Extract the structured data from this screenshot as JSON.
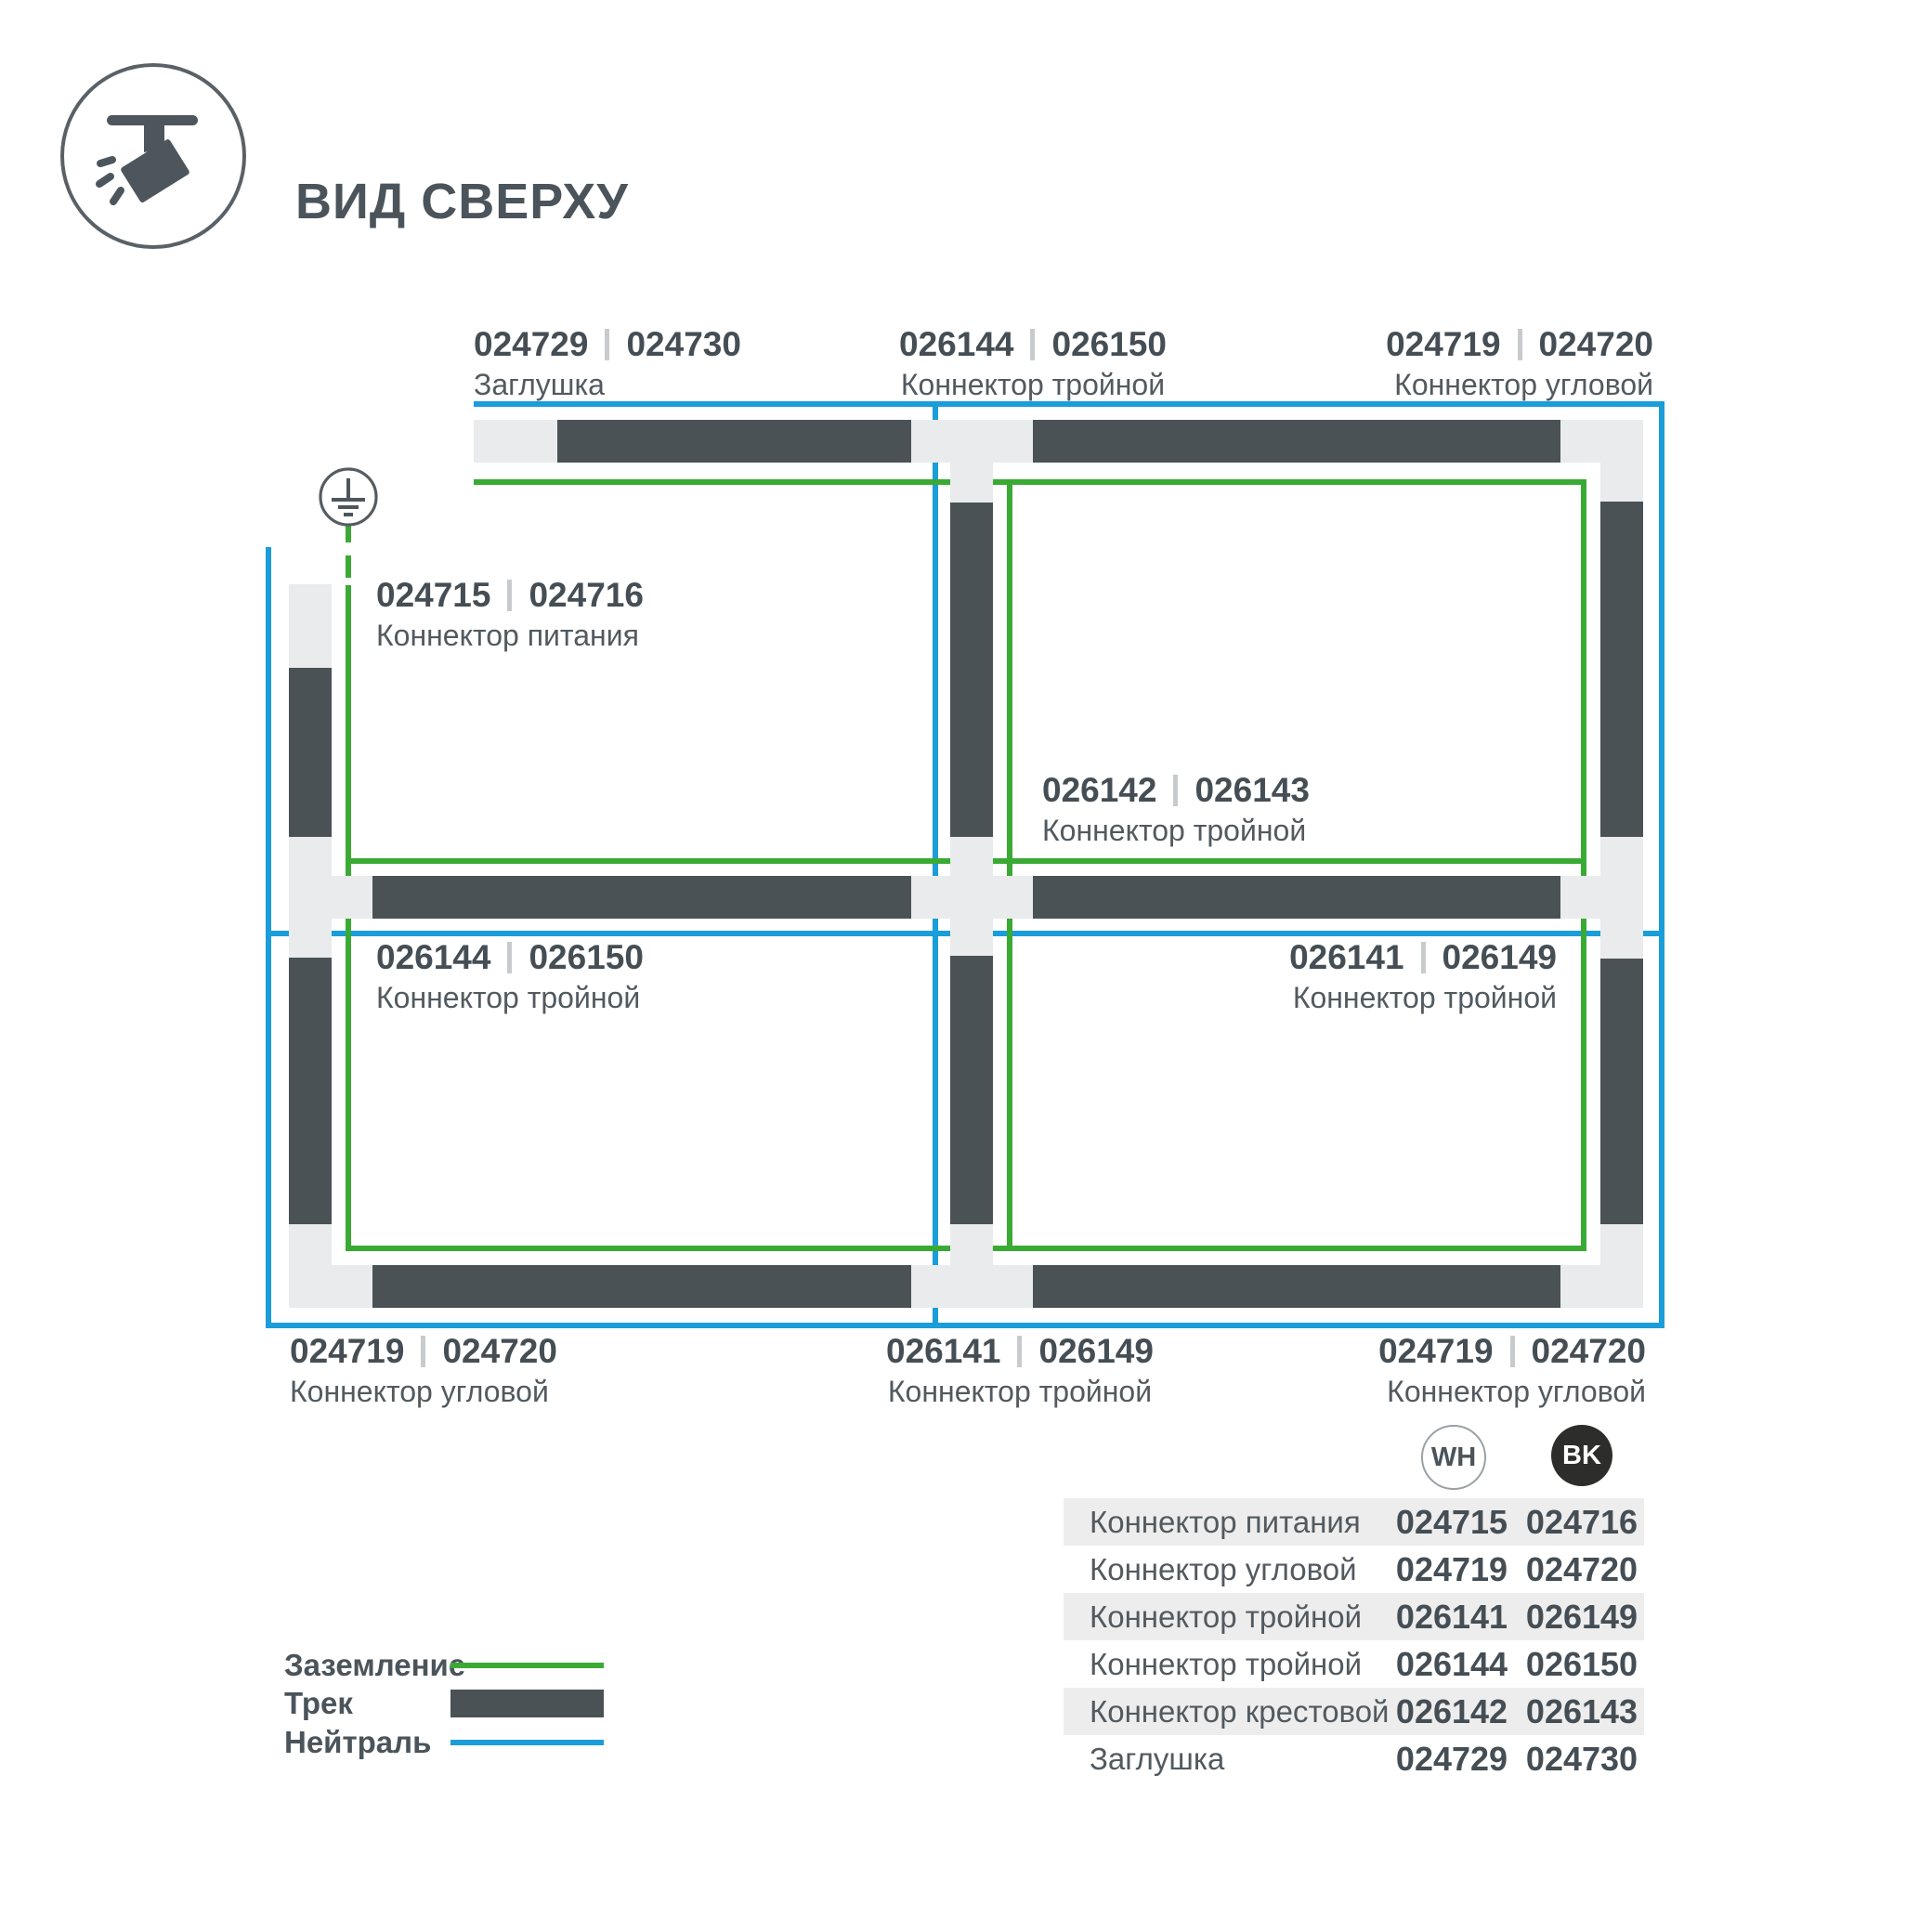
{
  "page": {
    "title": "ВИД СВЕРХУ"
  },
  "colors": {
    "track": "#4a5256",
    "connector": "#e9ebec",
    "ground": "#3aaa35",
    "neutral": "#1a9dd9",
    "text-dark": "#454e54",
    "text": "#525a60",
    "table-row": "#ededed",
    "bk-fill": "#2d2d2b"
  },
  "diagram": {
    "labels": [
      {
        "code_wh": "024729",
        "code_bk": "024730",
        "name": "Заглушка"
      },
      {
        "code_wh": "026144",
        "code_bk": "026150",
        "name": "Коннектор тройной"
      },
      {
        "code_wh": "024719",
        "code_bk": "024720",
        "name": "Коннектор угловой"
      },
      {
        "code_wh": "024715",
        "code_bk": "024716",
        "name": "Коннектор питания"
      },
      {
        "code_wh": "026142",
        "code_bk": "026143",
        "name": "Коннектор тройной"
      },
      {
        "code_wh": "026144",
        "code_bk": "026150",
        "name": "Коннектор тройной"
      },
      {
        "code_wh": "026141",
        "code_bk": "026149",
        "name": "Коннектор тройной"
      },
      {
        "code_wh": "024719",
        "code_bk": "024720",
        "name": "Коннектор угловой"
      },
      {
        "code_wh": "026141",
        "code_bk": "026149",
        "name": "Коннектор тройной"
      },
      {
        "code_wh": "024719",
        "code_bk": "024720",
        "name": "Коннектор угловой"
      }
    ]
  },
  "legend": {
    "items": [
      {
        "label": "Заземление",
        "swatch": "ground-line"
      },
      {
        "label": "Трек",
        "swatch": "track-bar"
      },
      {
        "label": "Нейтраль",
        "swatch": "neutral-line"
      }
    ]
  },
  "table": {
    "columns": [
      {
        "label": "WH"
      },
      {
        "label": "BK"
      }
    ],
    "rows": [
      {
        "name": "Коннектор питания",
        "wh": "024715",
        "bk": "024716"
      },
      {
        "name": "Коннектор угловой",
        "wh": "024719",
        "bk": "024720"
      },
      {
        "name": "Коннектор тройной",
        "wh": "026141",
        "bk": "026149"
      },
      {
        "name": "Коннектор тройной",
        "wh": "026144",
        "bk": "026150"
      },
      {
        "name": "Коннектор крестовой",
        "wh": "026142",
        "bk": "026143"
      },
      {
        "name": "Заглушка",
        "wh": "024729",
        "bk": "024730"
      }
    ]
  }
}
